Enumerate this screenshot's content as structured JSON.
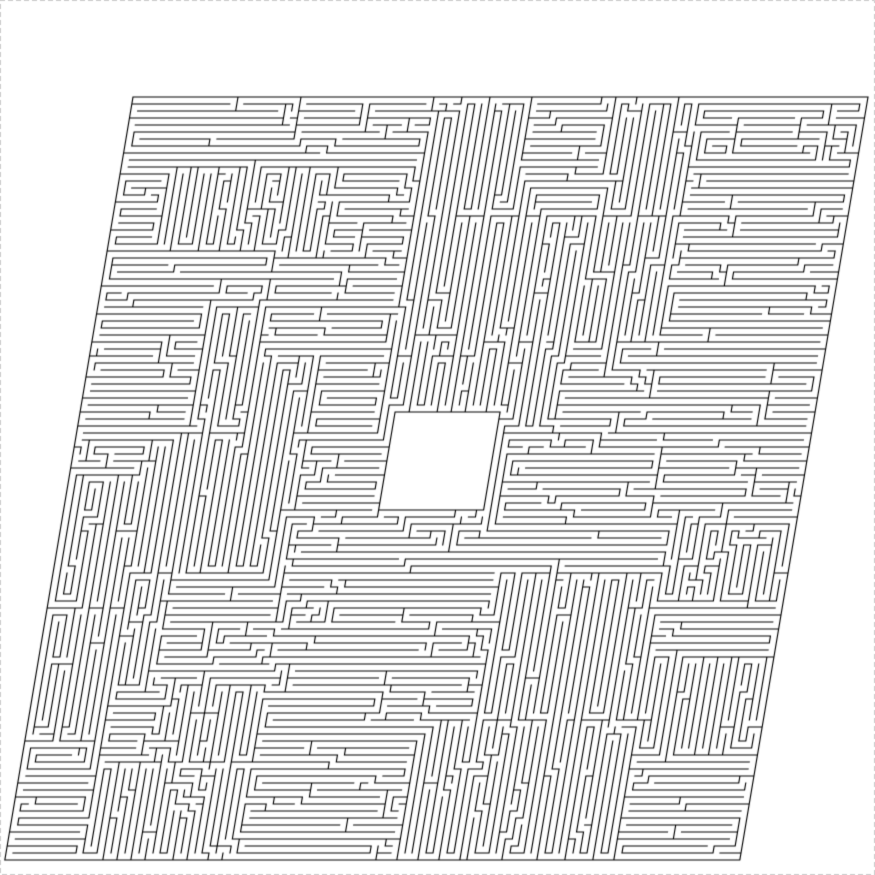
{
  "canvas": {
    "width": 875,
    "height": 875,
    "background": "#ffffff"
  },
  "frame": {
    "border_color": "#cbcbcb",
    "dash": [
      4,
      4
    ],
    "line_width": 1
  },
  "maze": {
    "wall_color": "#000000",
    "wall_width": 1.15,
    "origin_x": 133,
    "origin_y": 97,
    "shear": -0.168,
    "cell": 7,
    "cols": 105,
    "rows": 109,
    "hole": {
      "col0": 45,
      "row0": 45,
      "col1": 59,
      "row1": 58
    },
    "seed": 1203,
    "straight_bias": 5,
    "axis_bias": 7,
    "cross_block_weight": 0.03,
    "leaf_max": 24,
    "band_max": 9,
    "split_min": 6,
    "leaf_stop_prob": 0.5,
    "band_stop_prob": 0.55,
    "long_axis_orient_prob": 0.78
  }
}
